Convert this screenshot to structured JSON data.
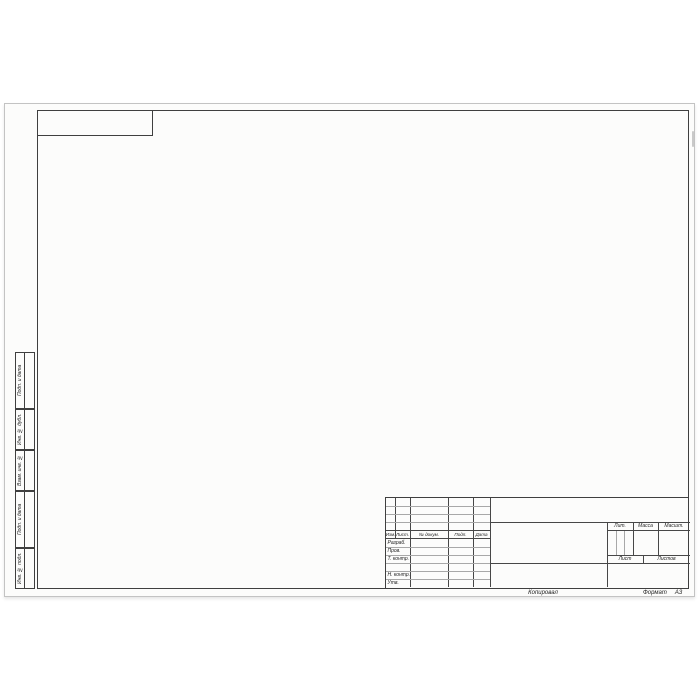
{
  "sheet": {
    "footer": {
      "copied": "Копировал",
      "format_label": "Формат",
      "format_value": "А3"
    }
  },
  "title_block": {
    "revision_header": {
      "izm": "Изм.",
      "list": "Лист.",
      "doc": "№ докум.",
      "podp": "Подп.",
      "data": "Дата"
    },
    "signature_rows": {
      "razrab": "Разраб.",
      "prov": "Пров.",
      "tkontr": "Т. контр.",
      "nkontr": "Н. контр.",
      "utv": "Утв."
    },
    "right_section": {
      "lit": "Лит.",
      "massa": "Масса",
      "masshtab": "Масшт.",
      "list": "Лист",
      "listov": "Листов"
    }
  },
  "margin_columns": [
    {
      "label": "Подп. и дата"
    },
    {
      "label": "Инв. № дубл."
    },
    {
      "label": "Взам. инв. №"
    },
    {
      "label": "Подп. и дата"
    },
    {
      "label": "Инв. № подл."
    }
  ],
  "colors": {
    "line_main": "#3f3f3f",
    "line_thin": "#a8a8a8",
    "paper": "#fcfcfb"
  }
}
